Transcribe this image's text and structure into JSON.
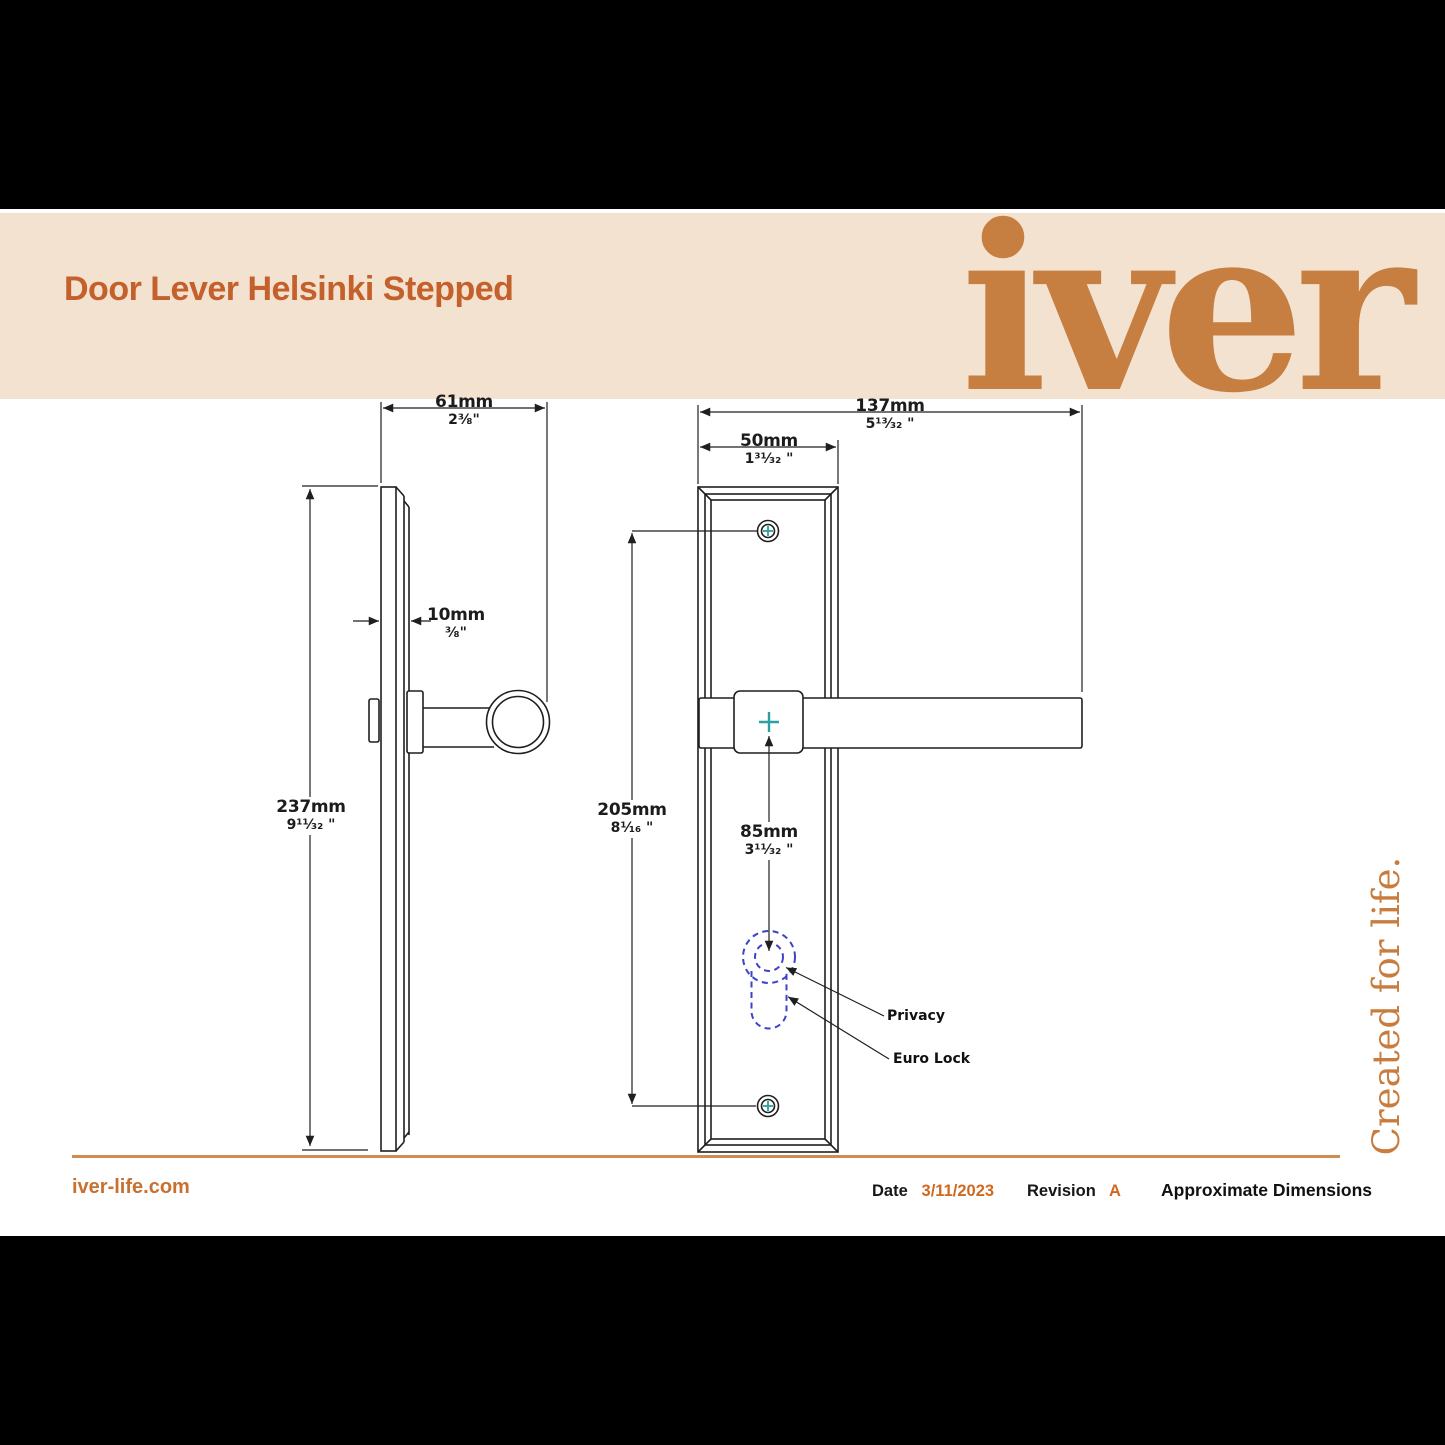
{
  "header": {
    "title": "Door Lever Helsinki Stepped",
    "logo": "iver"
  },
  "side_view": {
    "width": {
      "mm": "61mm",
      "inch": "2³⁄₈\""
    },
    "thickness": {
      "mm": "10mm",
      "inch": "³⁄₈\""
    },
    "height": {
      "mm": "237mm",
      "inch": "9¹¹⁄₃₂ \""
    }
  },
  "front_view": {
    "total_width": {
      "mm": "137mm",
      "inch": "5¹³⁄₃₂ \""
    },
    "plate_width": {
      "mm": "50mm",
      "inch": "1³¹⁄₃₂ \""
    },
    "fixing_centres": {
      "mm": "205mm",
      "inch": "8¹⁄₁₆ \""
    },
    "lock_centre": {
      "mm": "85mm",
      "inch": "3¹¹⁄₃₂ \""
    },
    "labels": {
      "privacy": "Privacy",
      "euro_lock": "Euro Lock"
    }
  },
  "tagline": "Created for life.",
  "footer": {
    "website": "iver-life.com",
    "date_label": "Date",
    "date_value": "3/11/2023",
    "revision_label": "Revision",
    "revision_value": "A",
    "note": "Approximate Dimensions"
  },
  "colors": {
    "accent_title": "#c4602b",
    "accent_logo": "#c67e41",
    "band": "#f3e2cf",
    "rule": "#cf8c4e",
    "date_value": "#d0691f",
    "drawing_line": "#1f1f1f",
    "keyhole_dash": "#3c43c8",
    "centre_cross": "#2aa0a0"
  }
}
